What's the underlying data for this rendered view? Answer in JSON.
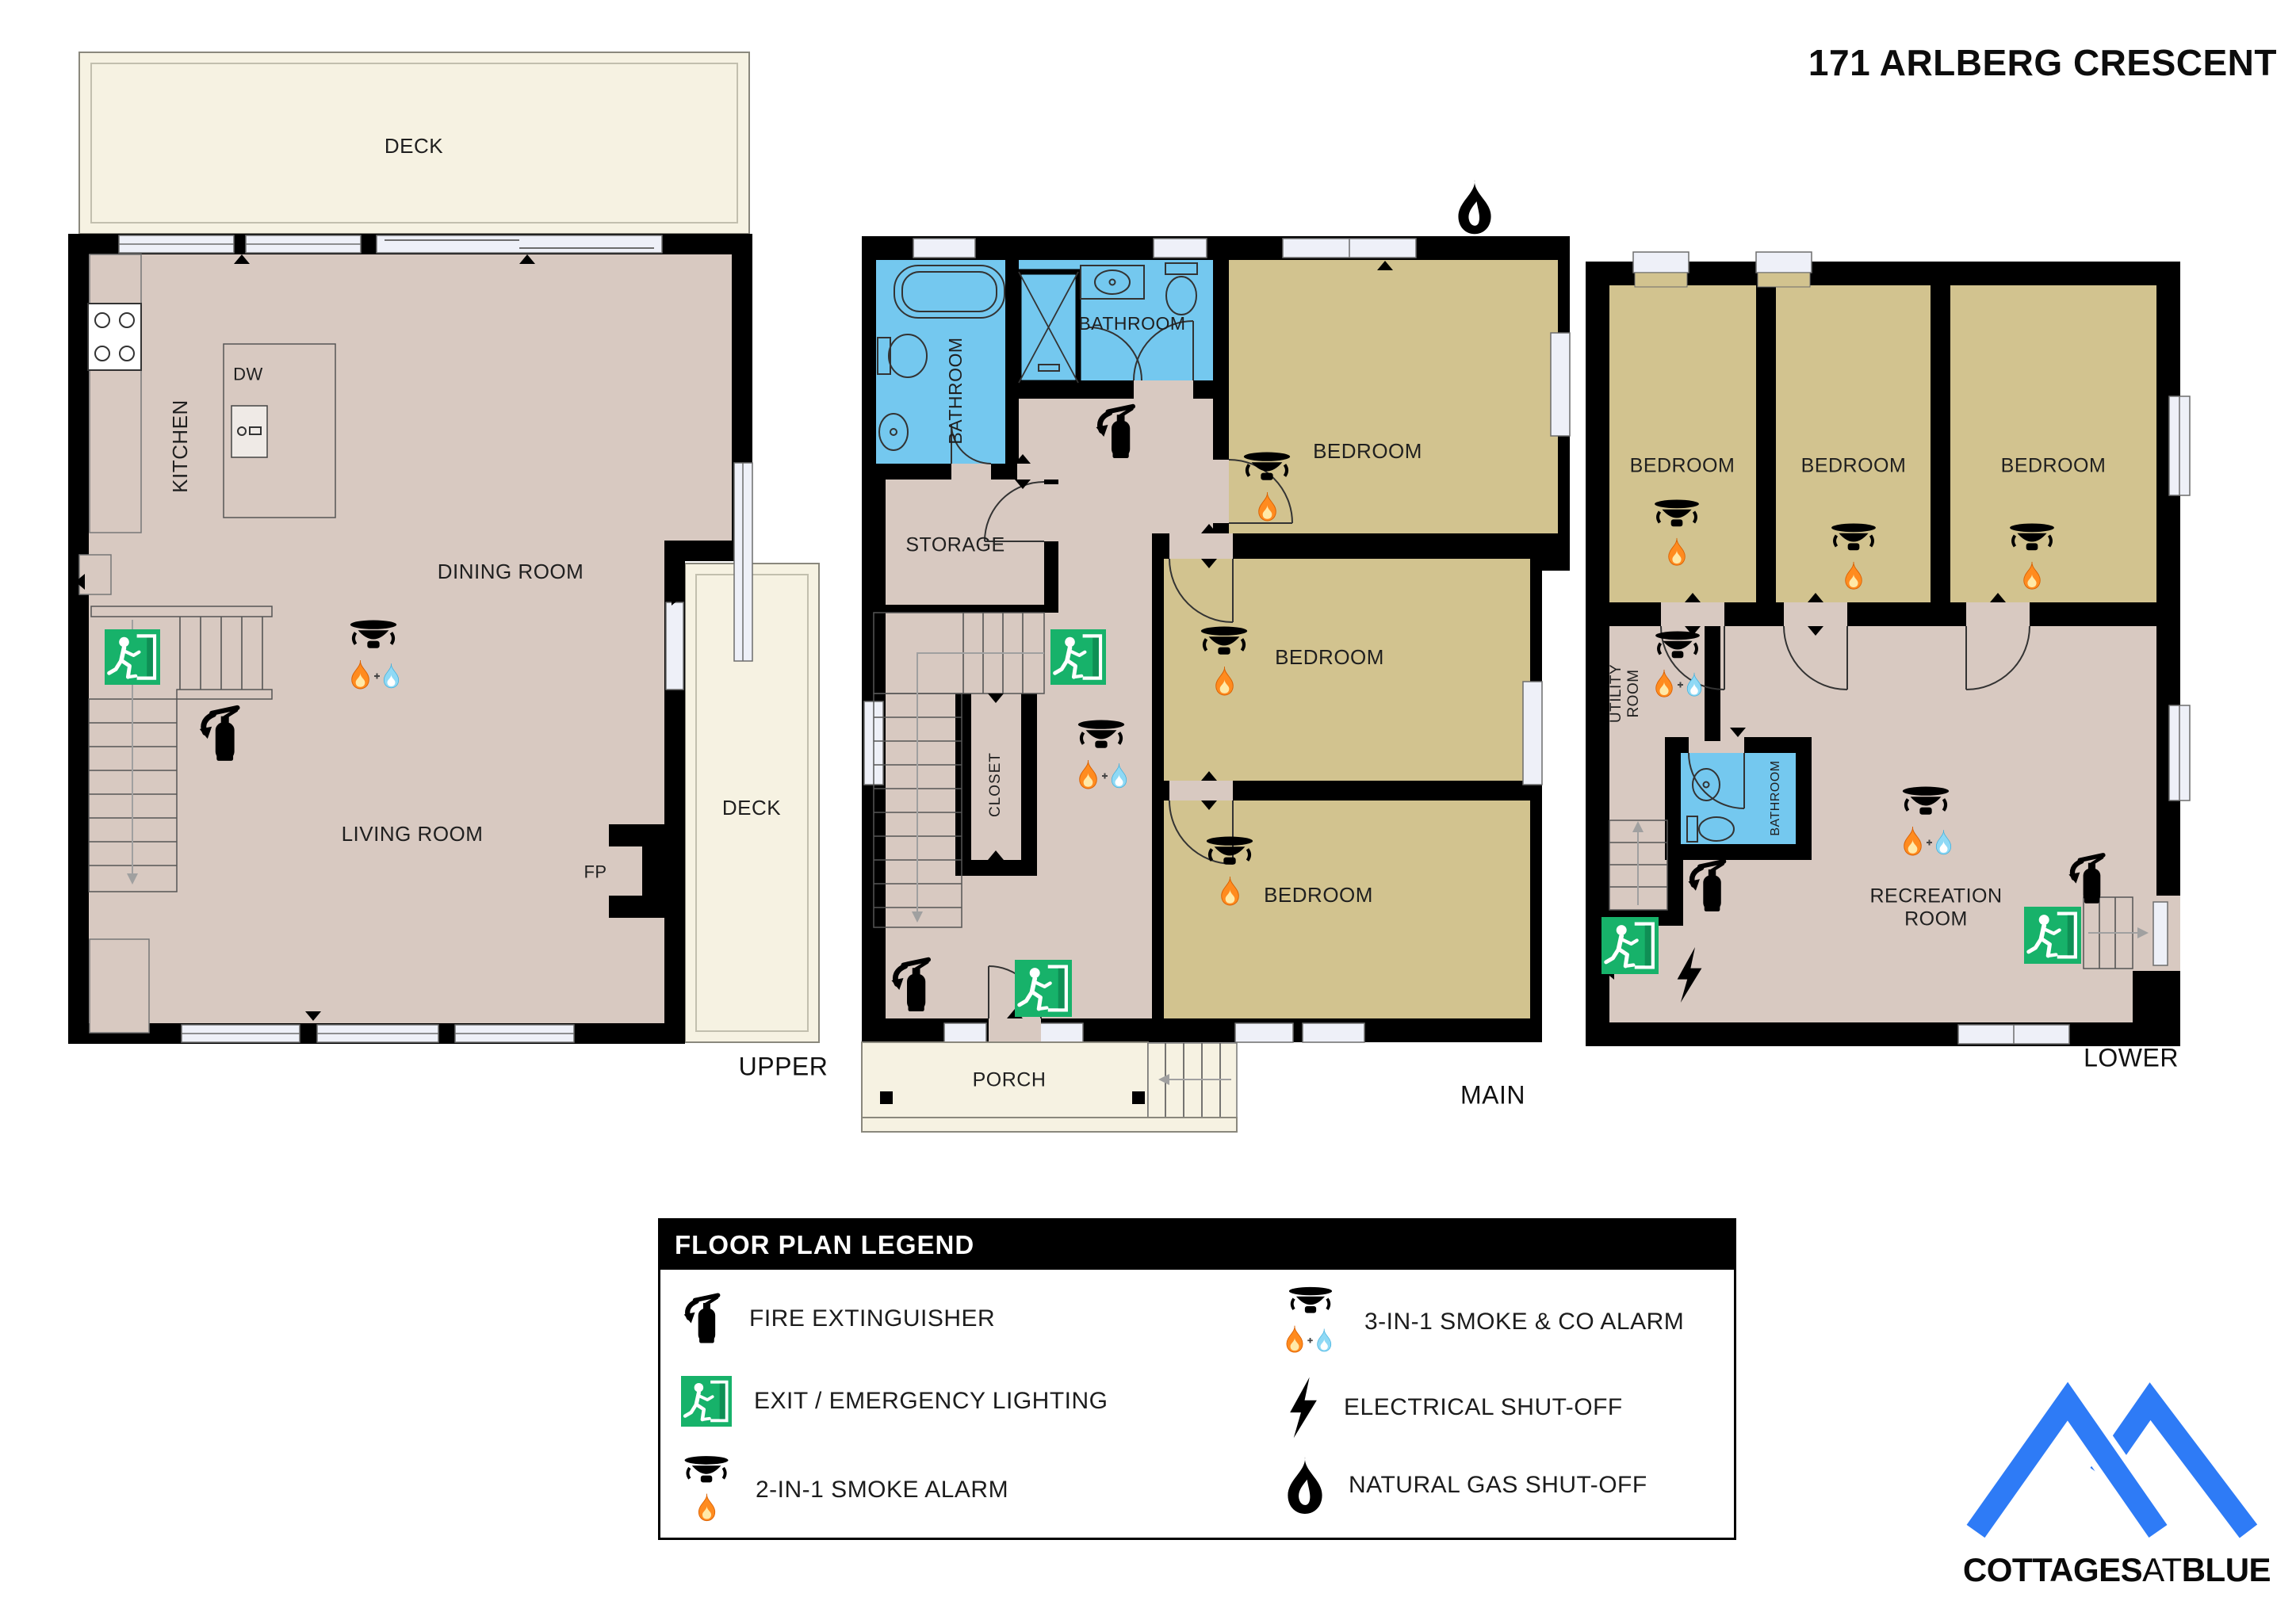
{
  "title": "171 ARLBERG CRESCENT",
  "floors": {
    "upper": {
      "label": "UPPER",
      "deck_top": "DECK",
      "deck_right": "DECK",
      "kitchen": "KITCHEN",
      "dining_room": "DINING ROOM",
      "living_room": "LIVING ROOM",
      "dw": "DW",
      "fp": "FP"
    },
    "main": {
      "label": "MAIN",
      "bathroom_left": "BATHROOM",
      "bathroom_right": "BATHROOM",
      "bedroom_top": "BEDROOM",
      "bedroom_middle": "BEDROOM",
      "bedroom_bottom": "BEDROOM",
      "storage": "STORAGE",
      "closet": "CLOSET",
      "porch": "PORCH"
    },
    "lower": {
      "label": "LOWER",
      "bedroom_left": "BEDROOM",
      "bedroom_center": "BEDROOM",
      "bedroom_right": "BEDROOM",
      "utility_line1": "UTILITY",
      "utility_line2": "ROOM",
      "bathroom": "BATHROOM",
      "recreation_line1": "RECREATION",
      "recreation_line2": "ROOM"
    }
  },
  "legend": {
    "title": "FLOOR PLAN LEGEND",
    "items": [
      {
        "icon": "fire-extinguisher-icon",
        "label": "FIRE EXTINGUISHER"
      },
      {
        "icon": "exit-emergency-lighting-icon",
        "label": "EXIT / EMERGENCY LIGHTING"
      },
      {
        "icon": "smoke-alarm-2in1-icon",
        "label": "2-IN-1 SMOKE ALARM"
      },
      {
        "icon": "smoke-co-alarm-3in1-icon",
        "label": "3-IN-1 SMOKE & CO ALARM"
      },
      {
        "icon": "electrical-shutoff-icon",
        "label": "ELECTRICAL SHUT-OFF"
      },
      {
        "icon": "natural-gas-shutoff-icon",
        "label": "NATURAL GAS SHUT-OFF"
      }
    ]
  },
  "logo": {
    "text_cottages": "COTTAGES",
    "text_at": "AT",
    "text_blue": "BLUE"
  },
  "colors": {
    "wall": "#000000",
    "floor": "#d8c9c1",
    "bedroom": "#d2c38f",
    "bathroom": "#74c8ef",
    "deck": "#f6f2e2",
    "exit_green": "#17b26a",
    "logo_blue": "#2e7bf6"
  }
}
